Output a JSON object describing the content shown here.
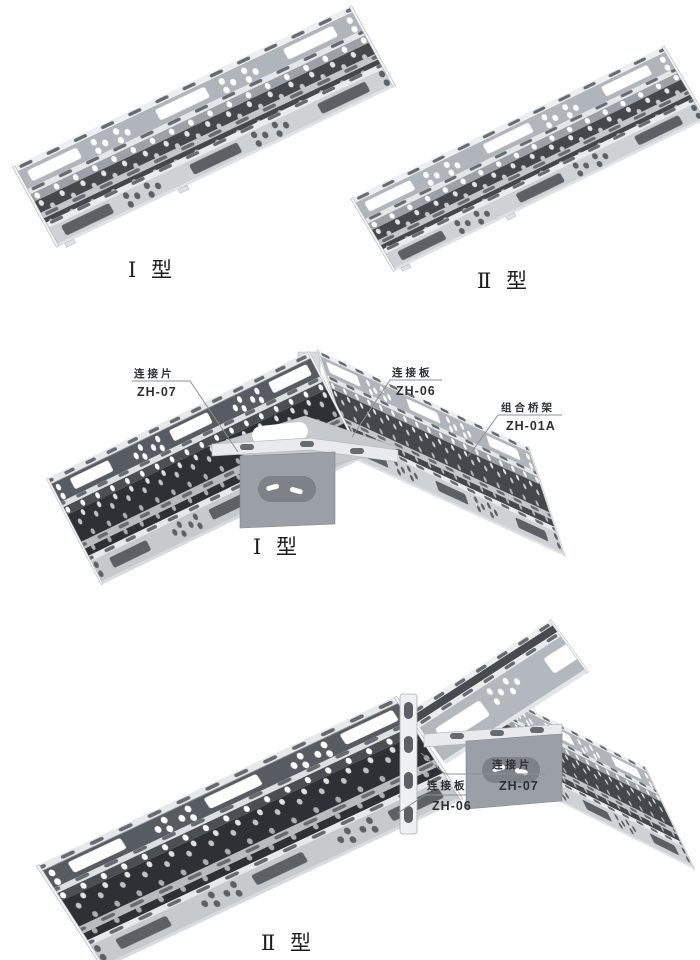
{
  "page": {
    "background": "#ffffff",
    "description_labels": {
      "top_left_label": "Ⅰ 型",
      "top_right_label": "Ⅱ 型",
      "middle_label": "Ⅰ 型",
      "bottom_label": "Ⅱ 型"
    }
  },
  "callouts": {
    "elbow_connector_piece": {
      "name": "连接片",
      "code": "ZH-07"
    },
    "elbow_connector_plate": {
      "name": "连接板",
      "code": "ZH-06"
    },
    "elbow_tray": {
      "name": "组合桥架",
      "code": "ZH-01A"
    },
    "tee_connector_piece": {
      "name": "连接片",
      "code": "ZH-07"
    },
    "tee_connector_plate": {
      "name": "连接板",
      "code": "ZH-06"
    }
  },
  "colors": {
    "background": "#ffffff",
    "flange_light": "#eceef0",
    "face_mid_gray": "#afb5bb",
    "face_light_gray": "#ced2d5",
    "face_shadow": "#565c62",
    "interior_dark": "#44484d",
    "interior_shadow": "#2d3135",
    "hole_dark": "#666b70",
    "leader_line": "#8a9094",
    "text": "#2e2f31"
  }
}
